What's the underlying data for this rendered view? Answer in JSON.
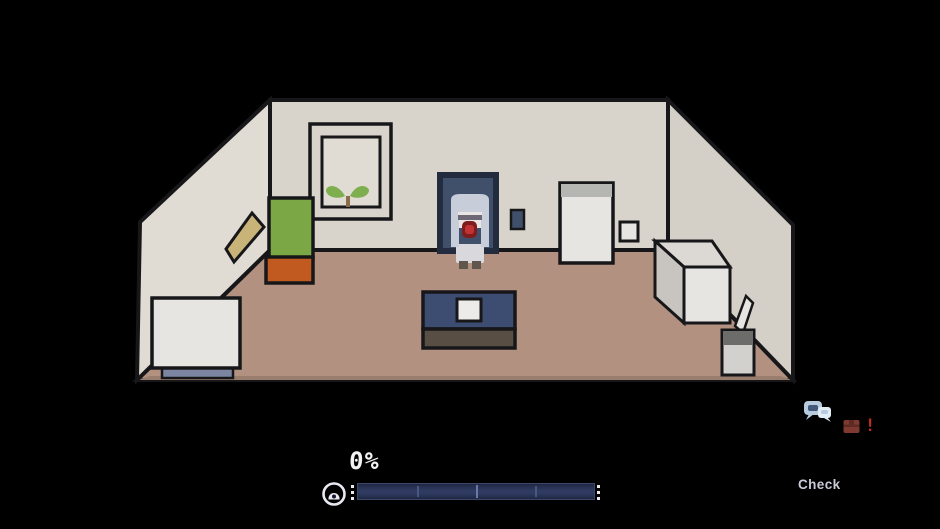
{
  "hud": {
    "progress_label": "0%",
    "progress_percent": 0,
    "action_label": "Check"
  },
  "indicators": {
    "gauge_icon": "eye-icon",
    "chat_icon": "chat-bubbles-icon",
    "item_alert_icon": "item-alert-icon",
    "item_alert_mark": "!"
  },
  "scene": {
    "objects": [
      "left-wall",
      "back-wall",
      "right-wall",
      "floor",
      "painting",
      "plant-sprout",
      "wall-shelf",
      "green-box",
      "orange-box",
      "doorway",
      "player-character",
      "light-switch",
      "refrigerator",
      "wall-panel",
      "storage-cube",
      "leaning-board",
      "trash-bin",
      "washing-machine",
      "tv-stand"
    ]
  },
  "colors": {
    "bg": "#000000",
    "outline": "#17171a",
    "wall": "#d9d4cb",
    "wall-left": "#e0dcd3",
    "wall-right": "#d5d0c7",
    "floor": "#b29181",
    "floor-dark": "#9a7e6d",
    "door": "#40506b",
    "door-frame": "#222c3e",
    "green-box": "#7ba844",
    "orange-box": "#c05a20",
    "shelf-tan": "#c8b478",
    "furniture-white": "#e7e5e1",
    "cube-top": "#dcd9d4",
    "cube-side": "#c8c5c0",
    "fridge-band": "#b5b5b1",
    "trash-lid": "#6c6c6a",
    "trash-body": "#d3d1cd",
    "base-blue": "#7c86a2",
    "tv-navy": "#3d4d72",
    "tv-base": "#584e44",
    "tv-screen": "#edebe9",
    "leaf-green": "#7fae4e",
    "stem-brown": "#8a6b4a",
    "hair": "#c8cdda",
    "skin": "#e9e5e3",
    "eye-band": "#6e6876",
    "mouth-dark": "#7e1d1d",
    "mouth": "#c23434",
    "dress": "#d9d9dd",
    "shoe": "#5f564e",
    "hud-text": "#f2f2f2",
    "check-text": "#c9c9da",
    "bar-bg": "#1f2744",
    "bar-mid": "#2f3b60",
    "bar-border": "#3c4668",
    "bar-tick": "#4a5780",
    "bar-tick-bright": "#6a79a8",
    "dot": "#e9e9f1",
    "chat-blue": "#b7cbdf",
    "chat-blue-light": "#e3edf6",
    "chat-dark": "#44597a",
    "alert-box": "#7e3a31",
    "alert-box-dark": "#5e2a24",
    "alert-red": "#c22a22"
  }
}
